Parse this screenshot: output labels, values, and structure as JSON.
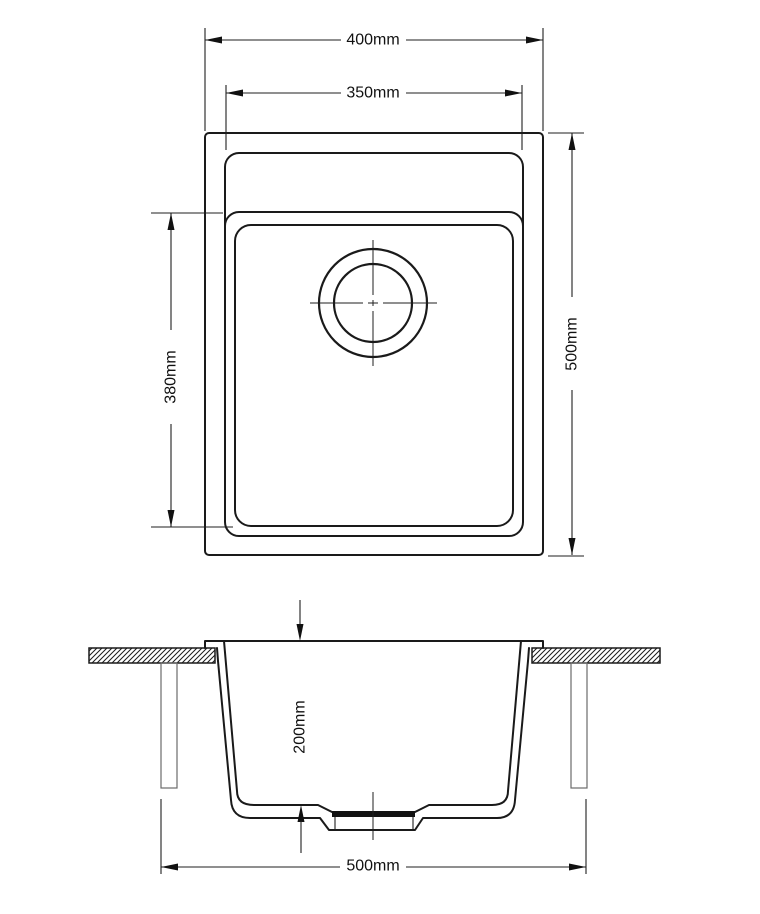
{
  "page": {
    "background_color": "#ffffff",
    "line_color": "#1a1a1a"
  },
  "dimensions": {
    "overall_width": "400mm",
    "bowl_opening_width": "350mm",
    "overall_length": "500mm",
    "bowl_length": "380mm",
    "bowl_depth": "200mm",
    "cabinet_width": "500mm"
  }
}
